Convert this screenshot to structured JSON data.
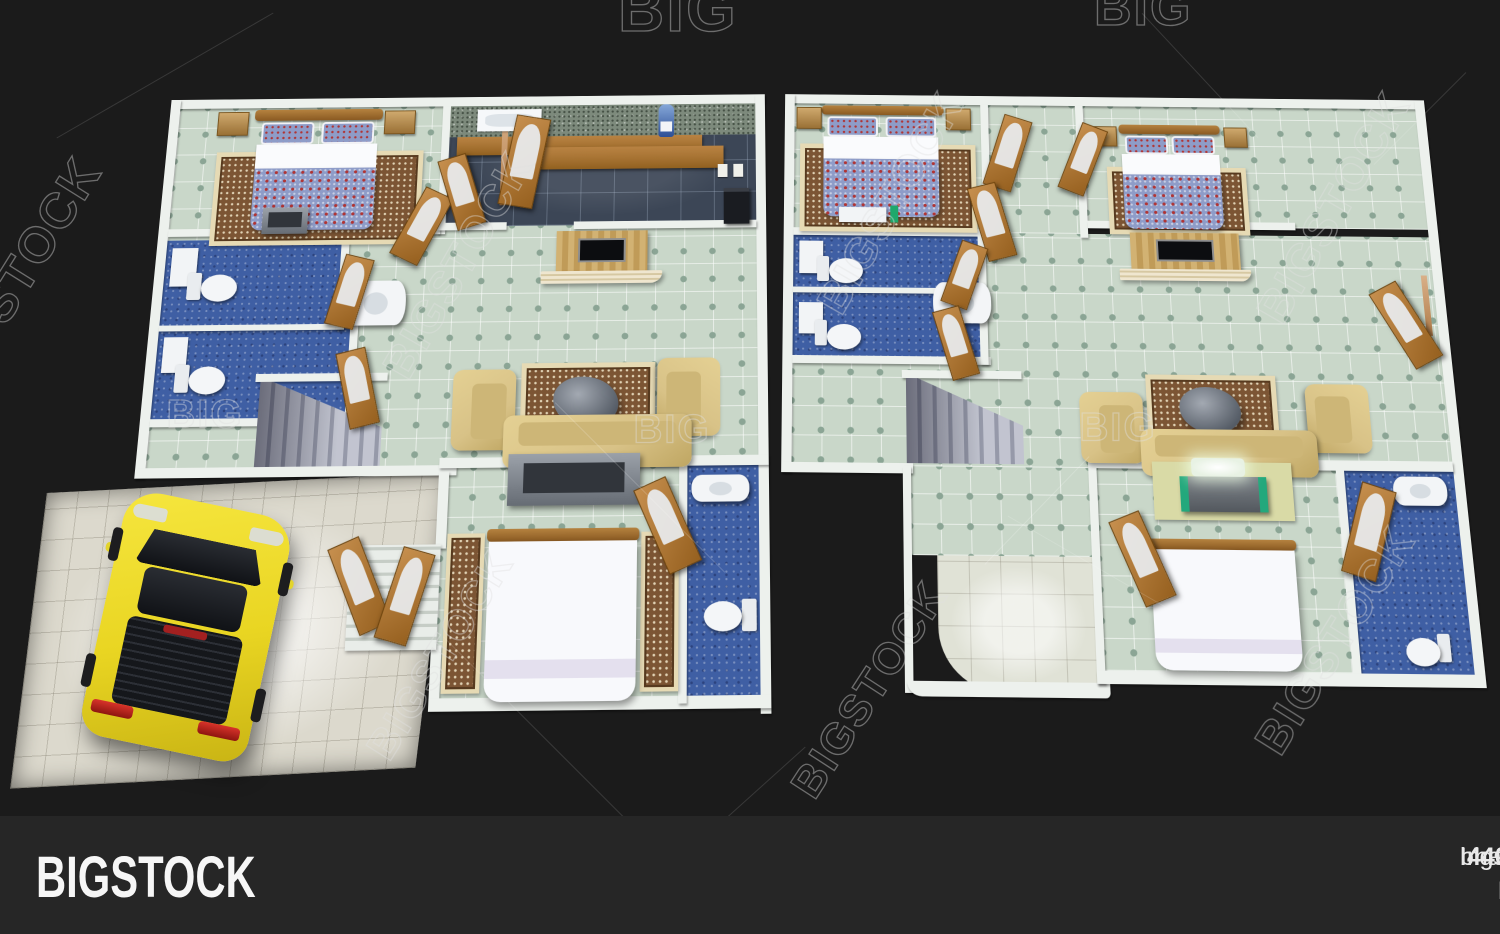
{
  "watermark": {
    "tile_text": "BIGSTOCK",
    "partial_top": "BIG",
    "partial_left": "STOCK"
  },
  "footer": {
    "logo": "BIGSTOCK",
    "image_id_label": "Image ID:",
    "image_id": "440873393",
    "website": "bigstock.com"
  },
  "colors": {
    "canvas_bg": "#1b1b1b",
    "footer_bg": "#262626",
    "footer_text": "#e9e9e9",
    "wall": "#edf1ed",
    "mint": "#c9d7c9",
    "mint_accent": "#8ba595",
    "kitchen_tile": "#3c4656",
    "bath_blue": "#3f5fa4",
    "sofa_tan": "#d8c287",
    "rug_brown": "#7c5534",
    "rug_border": "#e6dab4",
    "car_yellow": "#e9d522",
    "garage_floor": "#dcd9cd",
    "duvet_blue": "#8e9cc8",
    "duvet_red": "#b03434",
    "watermark_stroke": "rgba(225,225,225,0.42)"
  }
}
